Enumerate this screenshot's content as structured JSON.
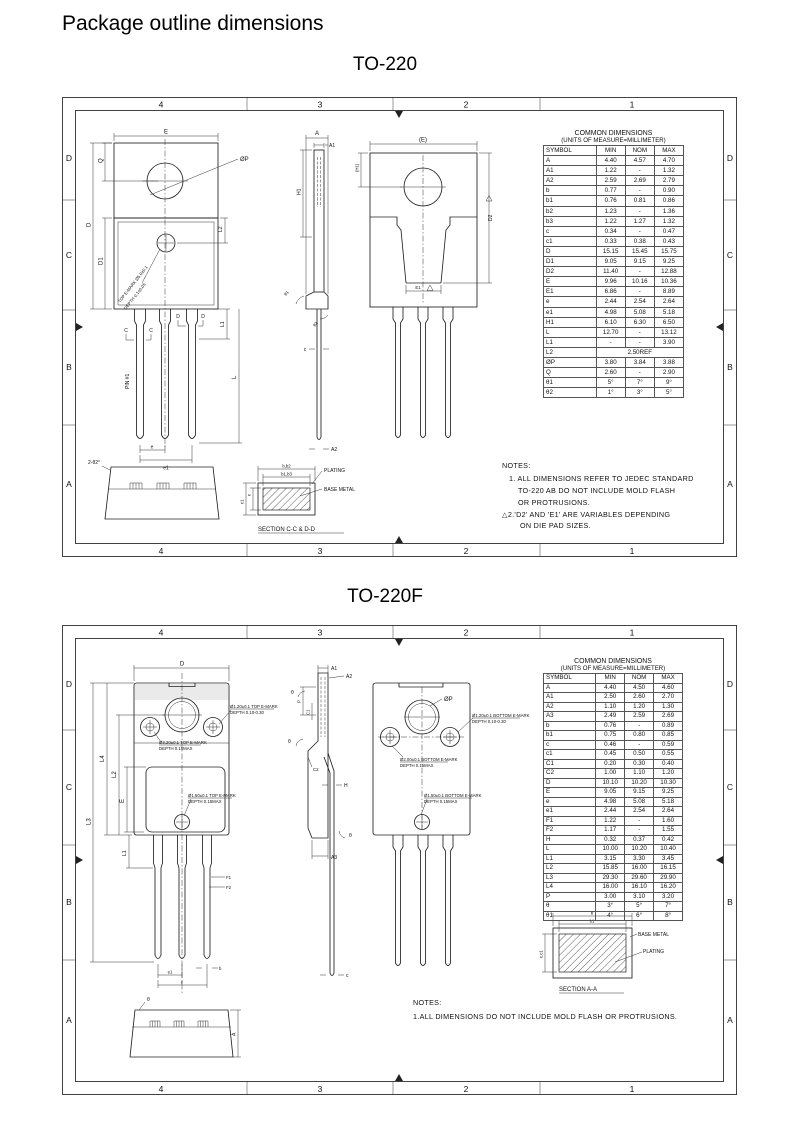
{
  "page": {
    "title": "Package outline dimensions"
  },
  "sheet1": {
    "title": "TO-220",
    "zc": [
      "4",
      "3",
      "2",
      "1"
    ],
    "zr": [
      "D",
      "C",
      "B",
      "A"
    ],
    "table": {
      "title": "COMMON DIMENSIONS",
      "subtitle": "(UNITS OF MEASURE=MILLIMETER)",
      "headers": [
        "SYMBOL",
        "MIN",
        "NOM",
        "MAX"
      ],
      "flags": [
        "D2",
        "E1",
        "e",
        "e1",
        "L"
      ],
      "rows": [
        [
          "A",
          "4.40",
          "4.57",
          "4.70"
        ],
        [
          "A1",
          "1.22",
          "-",
          "1.32"
        ],
        [
          "A2",
          "2.59",
          "2.69",
          "2.79"
        ],
        [
          "b",
          "0.77",
          "-",
          "0.90"
        ],
        [
          "b1",
          "0.76",
          "0.81",
          "0.86"
        ],
        [
          "b2",
          "1.23",
          "-",
          "1.36"
        ],
        [
          "b3",
          "1.22",
          "1.27",
          "1.32"
        ],
        [
          "c",
          "0.34",
          "-",
          "0.47"
        ],
        [
          "c1",
          "0.33",
          "0.38",
          "0.43"
        ],
        [
          "D",
          "15.15",
          "15.45",
          "15.75"
        ],
        [
          "D1",
          "9.05",
          "9.15",
          "9.25"
        ],
        [
          "D2",
          "11.40",
          "-",
          "12.88"
        ],
        [
          "E",
          "9.96",
          "10.16",
          "10.36"
        ],
        [
          "E1",
          "6.86",
          "-",
          "8.89"
        ],
        [
          "e",
          "2.44",
          "2.54",
          "2.64"
        ],
        [
          "e1",
          "4.98",
          "5.08",
          "5.18"
        ],
        [
          "H1",
          "6.10",
          "6.30",
          "6.50"
        ],
        [
          "L",
          "12.70",
          "-",
          "13.12"
        ],
        [
          "L1",
          "-",
          "-",
          "3.90"
        ],
        [
          "L2",
          {
            "text": "2.50REF",
            "span": 3
          }
        ],
        [
          "ØP",
          "3.80",
          "3.84",
          "3.88"
        ],
        [
          "Q",
          "2.60",
          "-",
          "2.90"
        ],
        [
          "θ1",
          "5°",
          "7°",
          "9°"
        ],
        [
          "θ2",
          "1°",
          "3°",
          "5°"
        ]
      ]
    },
    "front": {
      "E": "E",
      "phiP": "ØP",
      "Q": "Q",
      "D": "D",
      "D1": "D1",
      "L2": "L2",
      "pin1": "PIN #1",
      "cutC": "C",
      "cutD": "D",
      "L1": "L1",
      "L": "L",
      "e": "e",
      "e1": "e1",
      "emark1": "TOP E-MARK Ø5.0±0.1",
      "emark2": "DEPTH 0.1±0.05"
    },
    "side": {
      "A": "A",
      "A1": "A1",
      "A2": "A2",
      "H1": "H1",
      "t1": "θ1",
      "t2": "θ2",
      "c": "c"
    },
    "back": {
      "E": "(E)",
      "H1": "(H1)",
      "D2": "D2",
      "E1": "E1"
    },
    "bottom": {
      "label": "2-θ2°"
    },
    "section": {
      "b": "b,b2",
      "b1": "b1,b3",
      "c": "c",
      "c1": "c1",
      "plating": "PLATING",
      "base": "BASE METAL",
      "caption": "SECTION C-C & D-D"
    },
    "notes": {
      "l0": "NOTES:",
      "l1": "1. ALL DIMENSIONS REFER TO JEDEC STANDARD",
      "l2": "TO-220 AB DO NOT INCLUDE MOLD FLASH",
      "l3": "OR PROTRUSIONS.",
      "l4": "△2.'D2' AND 'E1' ARE VARIABLES DEPENDING",
      "l5": "ON DIE PAD SIZES."
    }
  },
  "sheet2": {
    "title": "TO-220F",
    "zc": [
      "4",
      "3",
      "2",
      "1"
    ],
    "zr": [
      "D",
      "C",
      "B",
      "A"
    ],
    "table": {
      "title": "COMMON DIMENSIONS",
      "subtitle": "(UNITS OF MEASURE=MILLIMETER)",
      "headers": [
        "SYMBOL",
        "MIN",
        "NOM",
        "MAX"
      ],
      "flags": [],
      "rows": [
        [
          "A",
          "4.40",
          "4.50",
          "4.60"
        ],
        [
          "A1",
          "2.50",
          "2.60",
          "2.70"
        ],
        [
          "A2",
          "1.10",
          "1.20",
          "1.30"
        ],
        [
          "A3",
          "2.49",
          "2.59",
          "2.69"
        ],
        [
          "b",
          "0.76",
          "-",
          "0.89"
        ],
        [
          "b1",
          "0.75",
          "0.80",
          "0.85"
        ],
        [
          "c",
          "0.46",
          "-",
          "0.59"
        ],
        [
          "c1",
          "0.45",
          "0.50",
          "0.55"
        ],
        [
          "C1",
          "0.20",
          "0.30",
          "0.40"
        ],
        [
          "C2",
          "1.00",
          "1.10",
          "1.20"
        ],
        [
          "D",
          "10.10",
          "10.20",
          "10.30"
        ],
        [
          "E",
          "9.05",
          "9.15",
          "9.25"
        ],
        [
          "e",
          "4.98",
          "5.08",
          "5.18"
        ],
        [
          "e1",
          "2.44",
          "2.54",
          "2.64"
        ],
        [
          "F1",
          "1.22",
          "-",
          "1.60"
        ],
        [
          "F2",
          "1.17",
          "-",
          "1.55"
        ],
        [
          "H",
          "0.32",
          "0.37",
          "0.42"
        ],
        [
          "L",
          "10.00",
          "10.20",
          "10.40"
        ],
        [
          "L1",
          "3.15",
          "3.30",
          "3.45"
        ],
        [
          "L2",
          "15.85",
          "16.00",
          "16.15"
        ],
        [
          "L3",
          "29.30",
          "29.60",
          "29.90"
        ],
        [
          "L4",
          "16.00",
          "16.10",
          "16.20"
        ],
        [
          "P",
          "3.00",
          "3.10",
          "3.20"
        ],
        [
          "θ",
          "3°",
          "5°",
          "7°"
        ],
        [
          "θ1",
          "4°",
          "6°",
          "8°"
        ]
      ]
    },
    "front": {
      "D": "D",
      "L1": "L1",
      "L2": "L2",
      "L3": "L3",
      "L4": "L4",
      "E": "E",
      "F1": "F1",
      "F2": "F2",
      "e": "e",
      "e1": "e1",
      "b": "b",
      "ann1a": "Ø3.20±0.1 TOP E-MARK",
      "ann1b": "DEPTH 0.15MAX",
      "ann2a": "Ø1.20±0.1 TOP E-MARK",
      "ann2b": "DEPTH 0.10-0.30",
      "ann3a": "Ø1.50±0.1 TOP E-MARK",
      "ann3b": "DEPTH 0.15MAX"
    },
    "side": {
      "A1": "A1",
      "A2": "A2",
      "A3": "A3",
      "P": "P",
      "C1": "C1",
      "C2": "C2",
      "H": "H",
      "t": "θ",
      "c": "c"
    },
    "back": {
      "phiP": "ØP",
      "ann1a": "Ø1.20±0.1 BOTTOM E-MARK",
      "ann1b": "DEPTH 0.10-0.30",
      "ann2a": "Ø2.00±0.1 BOTTOM E-MARK",
      "ann2b": "DEPTH 0.15MAX",
      "ann3a": "Ø1.50±0.1 BOTTOM E-MARK",
      "ann3b": "DEPTH 0.15MAX"
    },
    "bottom": {
      "t": "θ",
      "A": "A"
    },
    "section": {
      "b": "b",
      "b1": "b1",
      "c": "c,c1",
      "base": "BASE METAL",
      "plating": "PLATING",
      "caption": "SECTION A-A"
    },
    "notes": {
      "l0": "NOTES:",
      "l1": "1.ALL DIMENSIONS DO NOT INCLUDE MOLD FLASH OR PROTRUSIONS."
    }
  }
}
